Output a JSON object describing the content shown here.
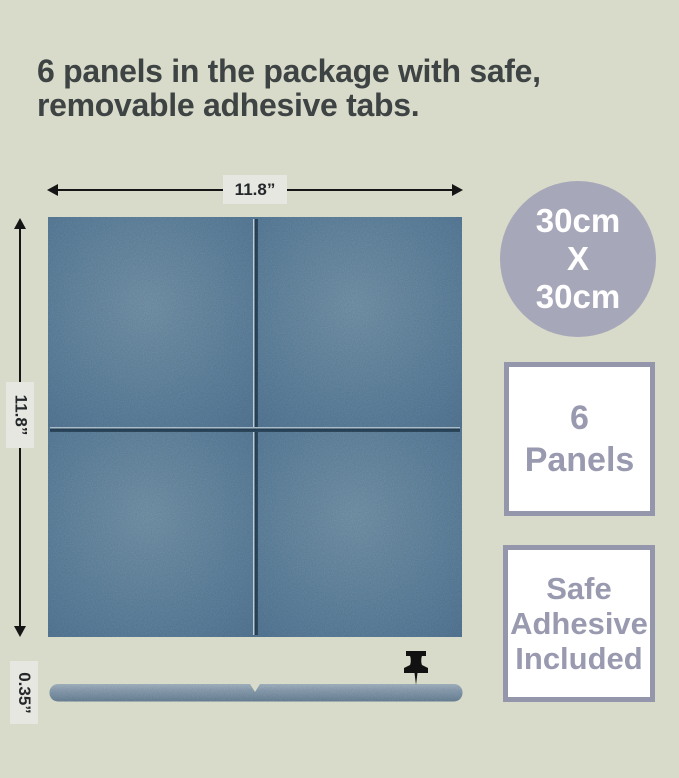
{
  "canvas": {
    "bg_color": "#d8dbc9"
  },
  "heading": {
    "line1": "6 panels in the package with safe,",
    "line2": "removable adhesive tabs.",
    "color": "#3e4344"
  },
  "dimensions": {
    "width_label": "11.8”",
    "height_label": "11.8”",
    "thickness_label": "0.35”"
  },
  "size_badge": {
    "line1": "30cm",
    "line2": "X",
    "line3": "30cm",
    "bg_color": "#a7a7ba",
    "text_color": "#ffffff"
  },
  "count_badge": {
    "line1": "6",
    "line2": "Panels",
    "border_color": "#9496ab",
    "text_color": "#999aaf"
  },
  "adhesive_badge": {
    "line1": "Safe",
    "line2": "Adhesive",
    "line3": "Included",
    "border_color": "#9496ab",
    "text_color": "#999aaf"
  },
  "panel": {
    "felt_color": "#4f6d86"
  },
  "side_view": {
    "color": "#7a8da0"
  },
  "icons": {
    "pushpin": "pushpin-icon"
  }
}
